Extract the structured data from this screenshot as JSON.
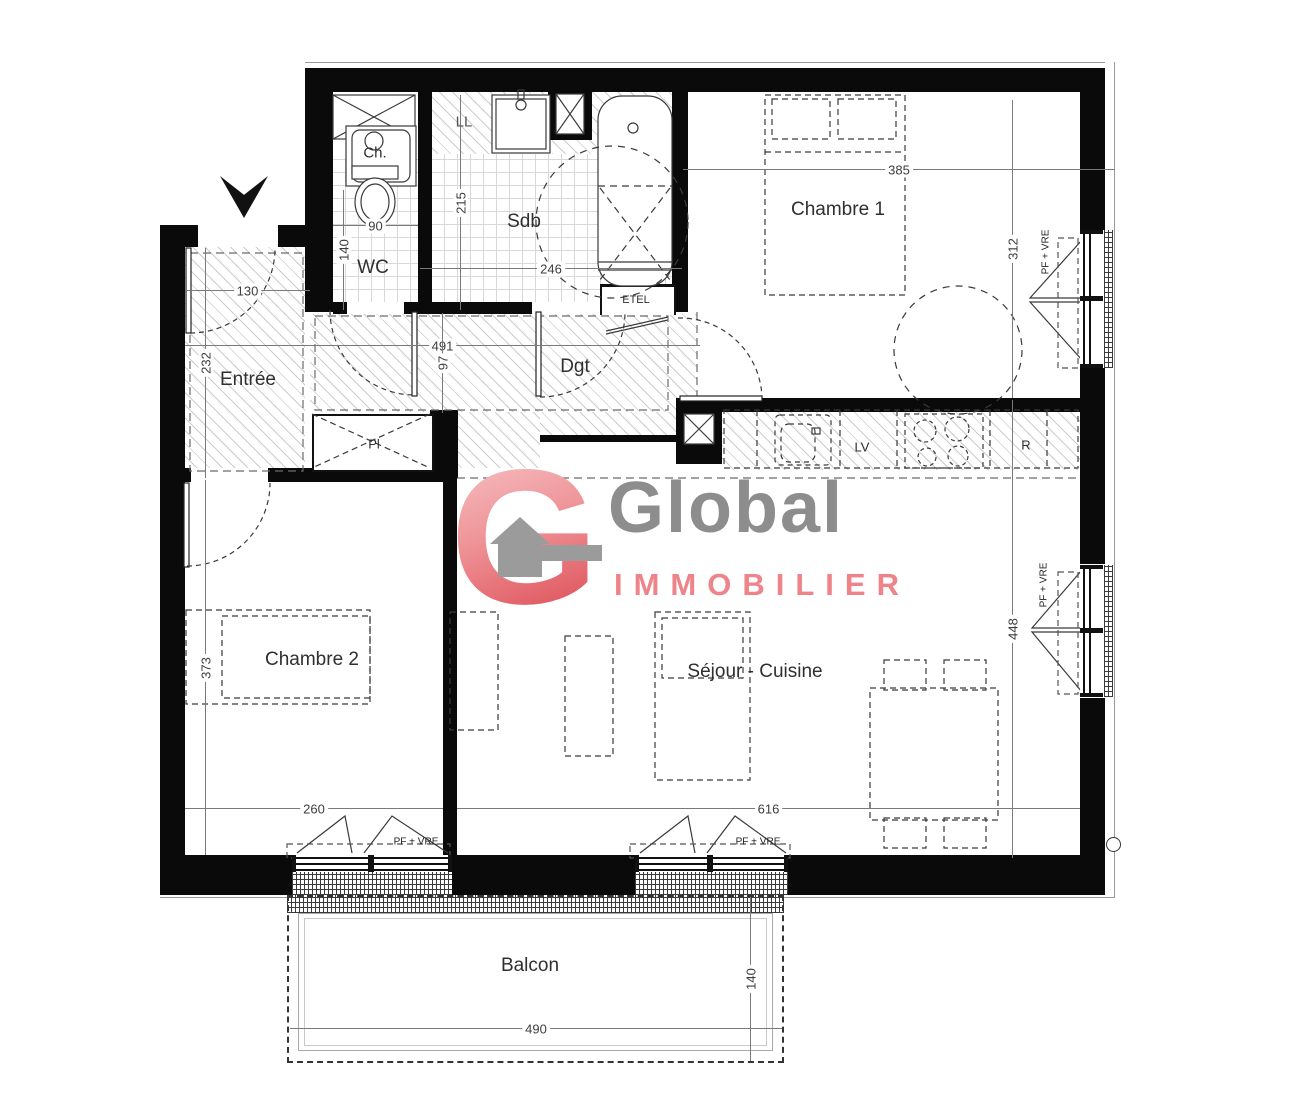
{
  "logo": {
    "g": "G",
    "name": "Global",
    "subtitle": "IMMOBILIER"
  },
  "rooms": {
    "entree": "Entrée",
    "wc": "WC",
    "sdb": "Sdb",
    "dgt": "Dgt",
    "chambre1": "Chambre 1",
    "chambre2": "Chambre 2",
    "sejour": "Séjour - Cuisine",
    "balcon": "Balcon"
  },
  "fixtures": {
    "water_heater": "Ch.",
    "washing_machine": "LL",
    "electrical_panel": "ETEL",
    "dishwasher": "LV",
    "fridge": "R",
    "closet": "Pl"
  },
  "window_label": "PF + VRE",
  "dims": {
    "chambre1_width": "385",
    "chambre1_depth": "312",
    "sdb_depth": "215",
    "sdb_width": "246",
    "wc_width": "90",
    "wc_depth": "140",
    "entree_width": "130",
    "entree_depth": "232",
    "dgt_length": "491",
    "dgt_width": "97",
    "chambre2_depth": "373",
    "chambre2_width": "260",
    "sejour_width": "616",
    "sejour_depth": "448",
    "balcon_width": "490",
    "balcon_depth": "140"
  },
  "colors": {
    "wall": "#0a0a0a",
    "hatch_line": "#cccccc",
    "dimension": "#7a7a7a",
    "logo_red": "#e0575f",
    "logo_gray": "#8d8d8d",
    "logo_pink": "#ee838a"
  }
}
